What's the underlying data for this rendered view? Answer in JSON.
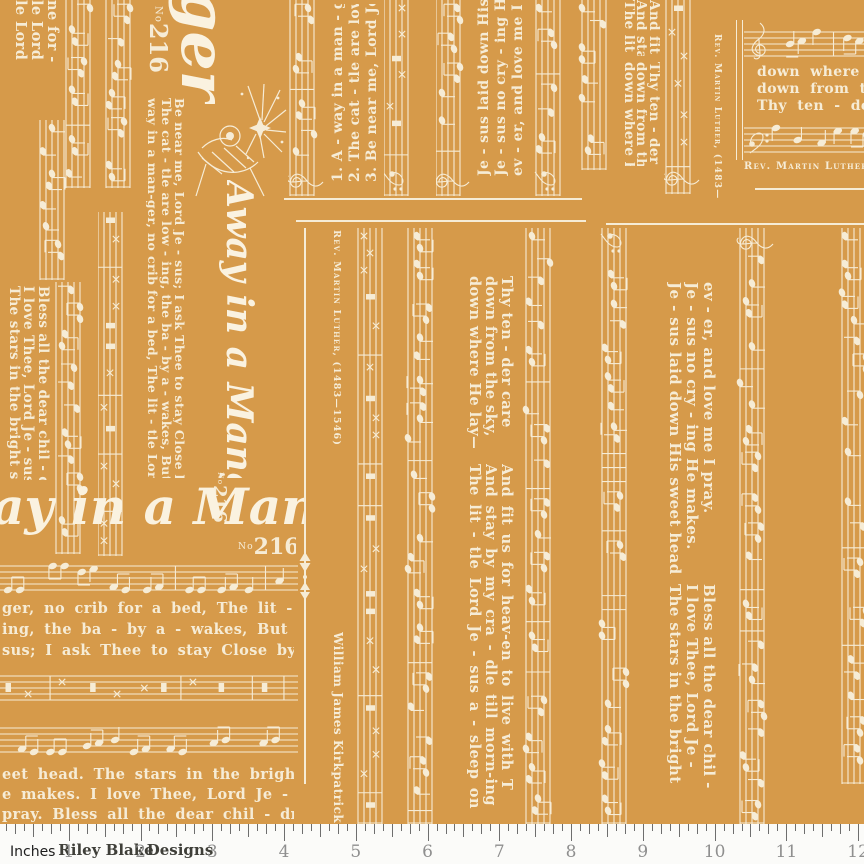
{
  "colors": {
    "fabric_background": "#d69a4a",
    "print_ink": "#f6ecd6",
    "ruler_background": "#fbfbf9",
    "ruler_tick": "#6e6e6e",
    "ruler_number": "#8f8f8f",
    "ruler_brand": "#3f3f39"
  },
  "fabric": {
    "title_fragments": {
      "corner": "ger",
      "vertical": "Away in a Manger",
      "horizontal": "ay in a Manger"
    },
    "catalog": {
      "prefix": "No",
      "number": "216"
    },
    "composer_caption": "Rev. Martin Luther, (1483—1546)",
    "composer_caption_truncated": "Rev. Martin Luther, (148",
    "arranger": "William James Kirkpatrick",
    "corner_fragment_lines": [
      "le Lord",
      "le Lord",
      "ne for -"
    ],
    "verse_numbers_lines": [
      "1. A - way in a man - ger,",
      "2. The cat - tle are low - ing,",
      "3. Be near me, Lord Je - sus;"
    ],
    "verse_long_lines": [
      "way in a man-ger, no crib for a bed, The lit - tle Lord",
      "The cat - tle are low - ing, the ba - by a - wakes, But lit - tle Lord",
      "Be near me, Lord Je - sus; I ask Thee to stay Close by me for -"
    ],
    "chorus_truncated_lines": [
      "Je - sus laid down His sweet hea",
      "Je - sus no cry - ing He mak",
      "ev - er, and love me I pra"
    ],
    "chorus_lines": [
      "Je - sus laid down His sweet head.",
      "Je - sus no cry - ing He makes.",
      "ev - er, and love me I pray."
    ],
    "lay_lines": [
      "down where He lay—",
      "down from the sky,",
      "Thy ten - der care"
    ],
    "lay_lines_truncated": [
      "down where He l",
      "down from the s",
      "Thy ten - der c"
    ],
    "lit_lines_short": [
      "The lit - t",
      "And stay b",
      "And fit"
    ],
    "sleep_lines": [
      "The lit - tle Lord Je - sus a - sleep on",
      "And stay by my cra - dle till morn-ing",
      "And fit us for heav-en to live with T"
    ],
    "stars_lines": [
      "The stars in the bright sky looked",
      "I love Thee, Lord Je - sus! look",
      "Bless all the dear chil - dren in"
    ],
    "stars_lines_truncated": [
      "The stars in the bright",
      "I love Thee, Lord Je -",
      "Bless all the dear chil -"
    ],
    "bottom_lines_upper": [
      "ger, no crib for a bed, The lit - tle Lord",
      "ing, the ba - by a - wakes, But lit - tle Lord",
      "sus; I ask Thee to stay Close by me for -"
    ],
    "bottom_lines_lower": [
      "eet head. The stars in the bright sky looked",
      "e makes. I love Thee, Lord Je - sus! look",
      "pray. Bless all the dear chil - dren in"
    ]
  },
  "ruler": {
    "unit_label": "Inches",
    "brand_1": "Riley Blake",
    "brand_2": "Designs",
    "numbers": [
      "1",
      "2",
      "3",
      "4",
      "5",
      "6",
      "7",
      "8",
      "9",
      "10",
      "11",
      "12"
    ]
  }
}
